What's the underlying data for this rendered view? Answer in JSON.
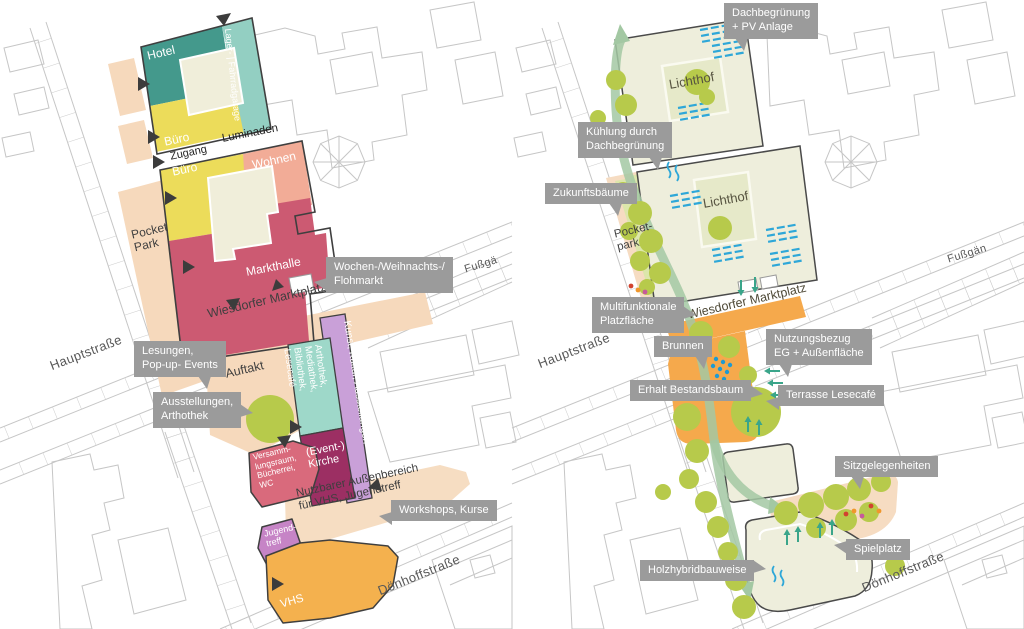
{
  "left": {
    "streets": {
      "hauptstrasse": "Hauptstraße",
      "doenhoffstrasse": "Dönhoffstraße",
      "fussgaengerzone": "Fußgä"
    },
    "zones": {
      "hotel": "Hotel",
      "lager": "Lager- | Fahrradgarage",
      "buero_oben": "Büro",
      "zugang": "Zugang",
      "luminaden": "Luminaden",
      "buero_unten": "Büro",
      "wohnen": "Wohnen",
      "markthalle": "Markthalle",
      "pocket_park": "Pocket\nPark",
      "marktplatz": "Wiesdorfer Marktplatz",
      "auftakt": "Auftakt",
      "mediathek": "Arthothek,\nMediathek,\nBibliothek,\nLesecafé",
      "kunst": "Kunst, Kultur, Ausstellungen",
      "kirche": "(Event-)\nKirche",
      "versammlung": "Versamm-\nlungsraum,\nBücherrei,\nWC",
      "aussenbereich": "Nutzbarer Außenbereich\nfür VHS, Jugendtreff",
      "jugendtreff": "Jugend-\ntreff",
      "vhs": "VHS"
    },
    "callouts": {
      "flohmarkt": "Wochen-/Weihnachts-/\nFlohmarkt",
      "lesungen": "Lesungen,\nPop-up- Events",
      "ausstellungen": "Ausstellungen,\nArthothek",
      "workshops": "Workshops, Kurse"
    }
  },
  "right": {
    "streets": {
      "hauptstrasse": "Hauptstraße",
      "doenhoffstrasse": "Dönhoffstraße",
      "fussgaengerzone": "Fußgän"
    },
    "zones": {
      "lichthof_oben": "Lichthof",
      "lichthof_unten": "Lichthof",
      "pocketpark": "Pocket-\npark",
      "marktplatz": "Wiesdorfer Marktplatz"
    },
    "callouts": {
      "dachbegruenung": "Dachbegrünung\n+ PV Anlage",
      "kuehlung": "Kühlung durch\nDachbegrünung",
      "zukunftsbaeume": "Zukunftsbäume",
      "multifunktional": "Multifunktionale\nPlatzfläche",
      "brunnen": "Brunnen",
      "nutzungsbezug": "Nutzungsbezug\nEG + Außenfläche",
      "erhalt": "Erhalt Bestandsbaum",
      "terrasse": "Terrasse Lesecafé",
      "sitzgelegenheiten": "Sitzgelegenheiten",
      "spielplatz": "Spielplatz",
      "holzhybrid": "Holzhybridbauweise"
    }
  },
  "palette": {
    "hotel_teal": "#44998c",
    "garage_hellteal": "#93cfc2",
    "mediathek_teal": "#9ed8c9",
    "buero_gelb": "#ecdc5a",
    "hof_creme": "#f0eeda",
    "wohnen_lachs": "#f2ac97",
    "markthalle_rot": "#cc5a72",
    "kirche_magenta": "#9c2f63",
    "kunst_lila": "#c9a0d8",
    "jugend_violett": "#c684c6",
    "vhs_orange": "#f4b14e",
    "platz_orange": "#f5a94c",
    "freiraum_peach": "#f6d9bc",
    "baum_gruen": "#b7ca4b",
    "dach_hellgruen": "#eeeedc",
    "pv_blau": "#2ea7d8",
    "wasser_blau": "#1f9ad2",
    "weg_gruen": "#a3c8a3",
    "callout_grau": "#9b9b9b"
  }
}
